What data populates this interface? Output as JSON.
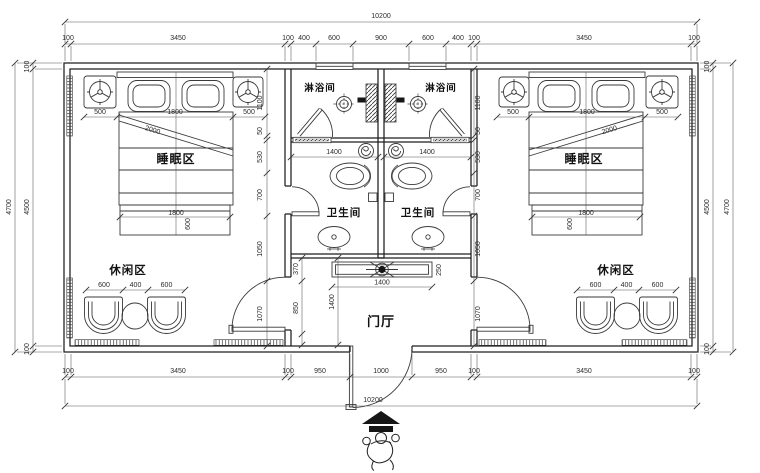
{
  "drawing": {
    "rooms": {
      "shower_left": "淋浴间",
      "shower_right": "淋浴间",
      "toilet_left": "卫生间",
      "toilet_right": "卫生间",
      "sleep_left": "睡眠区",
      "sleep_right": "睡眠区",
      "lounge_left": "休闲区",
      "lounge_right": "休闲区",
      "hall": "门厅"
    },
    "dims": {
      "total_top": "10200",
      "total_bottom": "10200",
      "top_row": [
        "100",
        "3450",
        "100",
        "400",
        "600",
        "900",
        "600",
        "400",
        "100",
        "3450",
        "100"
      ],
      "bottom_row": [
        "100",
        "3450",
        "100",
        "950",
        "1000",
        "950",
        "100",
        "3450",
        "100"
      ],
      "left_outer": "4700",
      "left_inner": "4500",
      "left_top_cap": "100",
      "left_bottom_cap": "100",
      "right_outer": "4700",
      "right_inner": "4500",
      "right_top_cap": "100",
      "right_bottom_cap": "100",
      "mid_chain_left": [
        "1100",
        "50",
        "530",
        "700",
        "1050",
        "1070"
      ],
      "mid_chain_right": [
        "1100",
        "50",
        "530",
        "700",
        "1050",
        "1070"
      ],
      "bed_left_row": [
        "500",
        "1800",
        "500"
      ],
      "bed_right_row": [
        "500",
        "1800",
        "500"
      ],
      "bed_diag_left": "2000",
      "bed_diag_right": "2000",
      "bench_left": "1800",
      "bench_left_depth": "600",
      "bench_right": "1800",
      "bench_right_depth": "600",
      "lounge_left_row": [
        "600",
        "400",
        "600"
      ],
      "lounge_right_row": [
        "600",
        "400",
        "600"
      ],
      "shower_left_width": "1400",
      "shower_right_width": "1400",
      "cabinet_width": "1400",
      "cabinet_depth": "250",
      "hall_depth": "1400",
      "hall_chain": [
        "370",
        "850"
      ]
    }
  }
}
